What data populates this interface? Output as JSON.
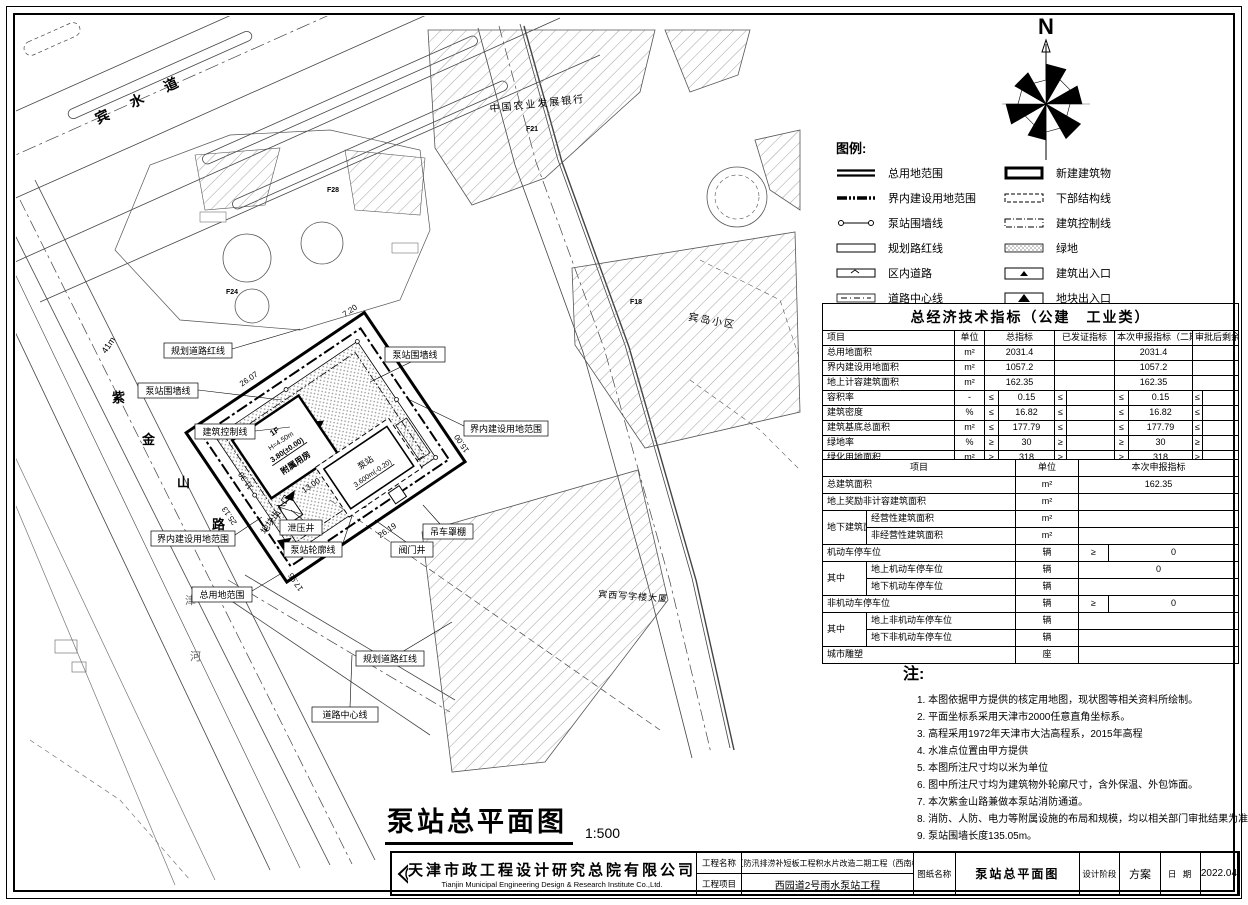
{
  "compass": {
    "north_label": "N"
  },
  "legend": {
    "title": "图例:",
    "items": [
      {
        "label": "总用地范围"
      },
      {
        "label": "新建建筑物"
      },
      {
        "label": "界内建设用地范围"
      },
      {
        "label": "下部结构线"
      },
      {
        "label": "泵站围墙线"
      },
      {
        "label": "建筑控制线"
      },
      {
        "label": "规划路红线"
      },
      {
        "label": "绿地"
      },
      {
        "label": "区内道路"
      },
      {
        "label": "建筑出入口"
      },
      {
        "label": "道路中心线"
      },
      {
        "label": "地块出入口"
      }
    ]
  },
  "indicators": {
    "title": "总经济技术指标（公建　工业类）",
    "headers": {
      "item": "项目",
      "unit": "单位",
      "total": "总指标",
      "certified": "已发证指标",
      "current": "本次申报指标（二期）",
      "remaining": "审批后剩余指标"
    },
    "rows": [
      {
        "item": "总用地面积",
        "unit": "m²",
        "cmp": "",
        "total": "2031.4",
        "certified": "",
        "current": "2031.4",
        "remaining": ""
      },
      {
        "item": "界内建设用地面积",
        "unit": "m²",
        "cmp": "",
        "total": "1057.2",
        "certified": "",
        "current": "1057.2",
        "remaining": ""
      },
      {
        "item": "地上计容建筑面积",
        "unit": "m²",
        "cmp": "",
        "total": "162.35",
        "certified": "",
        "current": "162.35",
        "remaining": ""
      },
      {
        "item": "容积率",
        "unit": "-",
        "cmp": "≤",
        "total": "0.15",
        "certified": "",
        "current": "0.15",
        "remaining": ""
      },
      {
        "item": "建筑密度",
        "unit": "%",
        "cmp": "≤",
        "total": "16.82",
        "certified": "",
        "current": "16.82",
        "remaining": ""
      },
      {
        "item": "建筑基底总面积",
        "unit": "m²",
        "cmp": "≤",
        "total": "177.79",
        "certified": "",
        "current": "177.79",
        "remaining": ""
      },
      {
        "item": "绿地率",
        "unit": "%",
        "cmp": "≥",
        "total": "30",
        "certified": "",
        "current": "30",
        "remaining": ""
      },
      {
        "item": "绿化用地面积",
        "unit": "m²",
        "cmp": "≥",
        "total": "318",
        "certified": "",
        "current": "318",
        "remaining": ""
      }
    ]
  },
  "declare": {
    "headers": {
      "item": "项目",
      "unit": "单位",
      "value": "本次申报指标"
    },
    "rows": {
      "total_area": {
        "item": "总建筑面积",
        "unit": "m²",
        "value": "162.35"
      },
      "bonus_area": {
        "item": "地上奖励非计容建筑面积",
        "unit": "m²",
        "value": ""
      },
      "underground_group": "地下建筑面积",
      "ug_business": {
        "item": "经营性建筑面积",
        "unit": "m²",
        "value": ""
      },
      "ug_nonbusiness": {
        "item": "非经营性建筑面积",
        "unit": "m²",
        "value": ""
      },
      "motor_parking": {
        "item": "机动车停车位",
        "unit": "辆",
        "cmp": "≥",
        "value": "0"
      },
      "among1": "其中",
      "motor_above": {
        "item": "地上机动车停车位",
        "unit": "辆",
        "value": "0"
      },
      "motor_below": {
        "item": "地下机动车停车位",
        "unit": "辆",
        "value": ""
      },
      "nonmotor_parking": {
        "item": "非机动车停车位",
        "unit": "辆",
        "cmp": "≥",
        "value": "0"
      },
      "among2": "其中",
      "nonmotor_above": {
        "item": "地上非机动车停车位",
        "unit": "辆",
        "value": ""
      },
      "nonmotor_below": {
        "item": "地下非机动车停车位",
        "unit": "辆",
        "value": ""
      },
      "sculpture": {
        "item": "城市雕塑",
        "unit": "座",
        "value": ""
      }
    }
  },
  "notes": {
    "title": "注:",
    "items": [
      "1. 本图依据甲方提供的核定用地图，现状图等相关资料所绘制。",
      "2. 平面坐标系采用天津市2000任意直角坐标系。",
      "3. 高程采用1972年天津市大沽高程系，2015年高程",
      "4. 水准点位置由甲方提供",
      "5. 本图所注尺寸均以米为单位",
      "6. 图中所注尺寸均为建筑物外轮廓尺寸，含外保温、外包饰面。",
      "7. 本次紫金山路兼做本泵站消防通道。",
      "8. 消防、人防、电力等附属设施的布局和规模，均以相关部门审批结果为准。",
      "9. 泵站围墙长度135.05m。"
    ]
  },
  "titleblock": {
    "company_cn": "天津市政工程设计研究总院有限公司",
    "company_en": "Tianjin Municipal Engineering Design & Research Institute Co.,Ltd.",
    "project_name_label": "工程名称",
    "project_name": "中心城区防汛排涝补短板工程积水片改造二期工程（西南楼地区）",
    "project_item_label": "工程项目",
    "project_item": "西园道2号雨水泵站工程",
    "drawing_label": "图纸名称",
    "drawing_name": "泵站总平面图",
    "stage_label": "设计阶段",
    "stage": "方案",
    "date_label": "日 期",
    "date": "2022.04"
  },
  "plan": {
    "title": "泵站总平面图",
    "scale": "1:500",
    "streets": {
      "binshui": "宾  水  道",
      "zijin_1": "紫",
      "zijin_2": "金",
      "zijin_3": "山",
      "zijin_4": "路",
      "river_1": "津",
      "river_2": "河"
    },
    "blocks": {
      "bank": "中国农业发展银行",
      "residential": "宾岛小区",
      "office": "宾西写字楼大厦",
      "f18": "F18",
      "f21": "F21",
      "f24": "F24",
      "f28": "F28"
    },
    "callouts": {
      "planning_red_line_top": "规划道路红线",
      "fence_left": "泵站围墙线",
      "fence_right": "泵站围墙线",
      "building_control": "建筑控制线",
      "inner_boundary_left": "界内建设用地范围",
      "inner_boundary_right": "界内建设用地范围",
      "total_boundary": "总用地范围",
      "relief_well": "泄压井",
      "pump_outline": "泵站轮廓线",
      "valve_well": "阀门井",
      "crane_canopy": "吊车罩棚",
      "plot_entrance": "地块出入口",
      "road_center": "道路中心线",
      "planning_red_line_bottom": "规划道路红线"
    },
    "site": {
      "floor": "1F",
      "height": "H=4.50m",
      "elev1": "3.80(±0.00)",
      "building1": "附属用房",
      "pump": "泵站",
      "elev2": "3.600m(-0.20)"
    },
    "dims": {
      "d26_07": "26.07",
      "d7_20": "7.20",
      "d25_13": "25.13",
      "d13_00": "13.00",
      "d11_30": "11.30",
      "d17_96": "17.96",
      "d26_19": "26.19",
      "d15_00": "15.00",
      "d41": "41m"
    }
  }
}
